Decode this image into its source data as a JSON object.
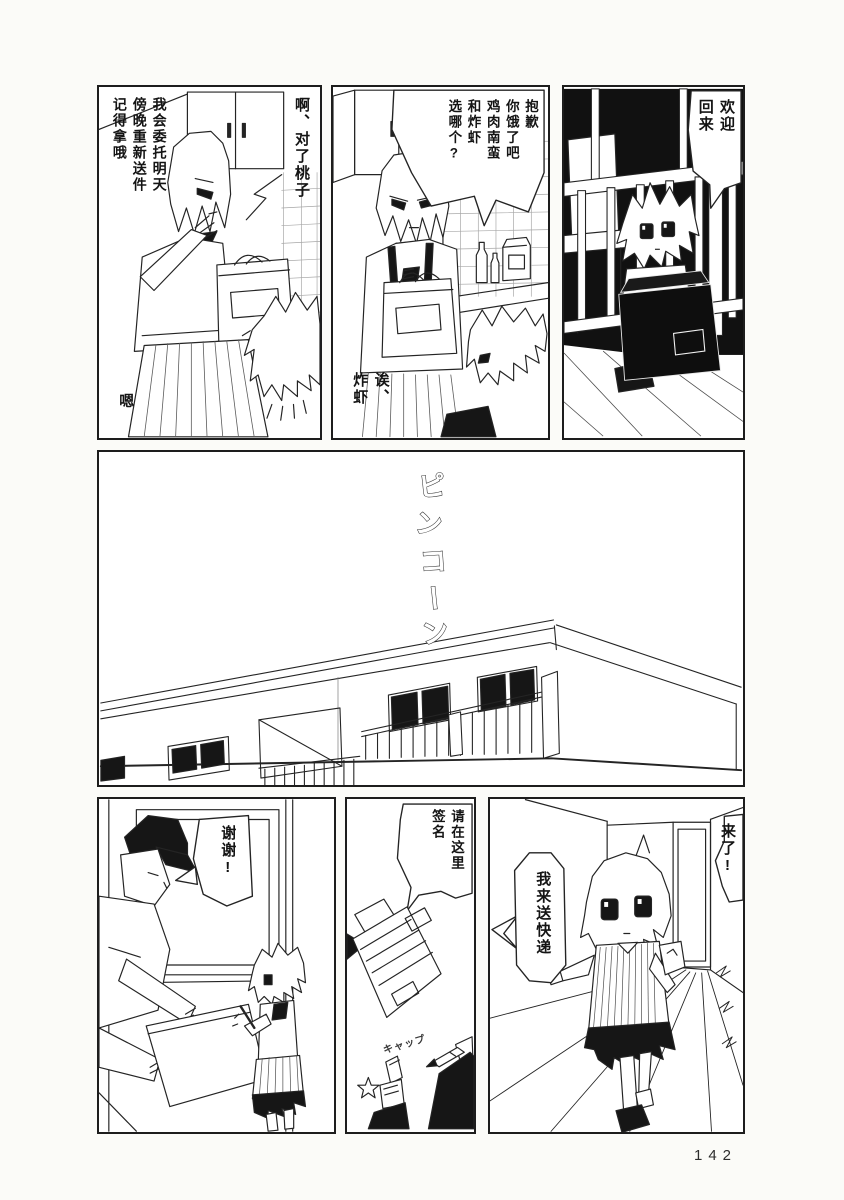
{
  "page_number": "142",
  "panels": {
    "balcony_welcome": {
      "bubble": "欢迎\n回来"
    },
    "kitchen_choice": {
      "bubble": "抱歉\n你饿了吧\n鸡肉南蛮\n和炸虾\n选哪个?",
      "reply": "诶、\n炸虾"
    },
    "kitchen_reminder": {
      "speech_momoko": "啊、对了桃子",
      "speech_redelivery": "我会委托明天\n傍晚重新送件\n记得拿哦",
      "reply": "嗯"
    },
    "hallway_coming": {
      "bubble_coming": "来了!",
      "bubble_delivery": "我来送快递"
    },
    "sign_here": {
      "bubble": "请在这里\n签名",
      "sfx_cap": "キャップ"
    },
    "door_thanks": {
      "bubble": "谢谢!"
    }
  },
  "sfx": {
    "doorbell": [
      "ピ",
      "ン",
      "コ",
      "ー",
      "ン"
    ]
  }
}
